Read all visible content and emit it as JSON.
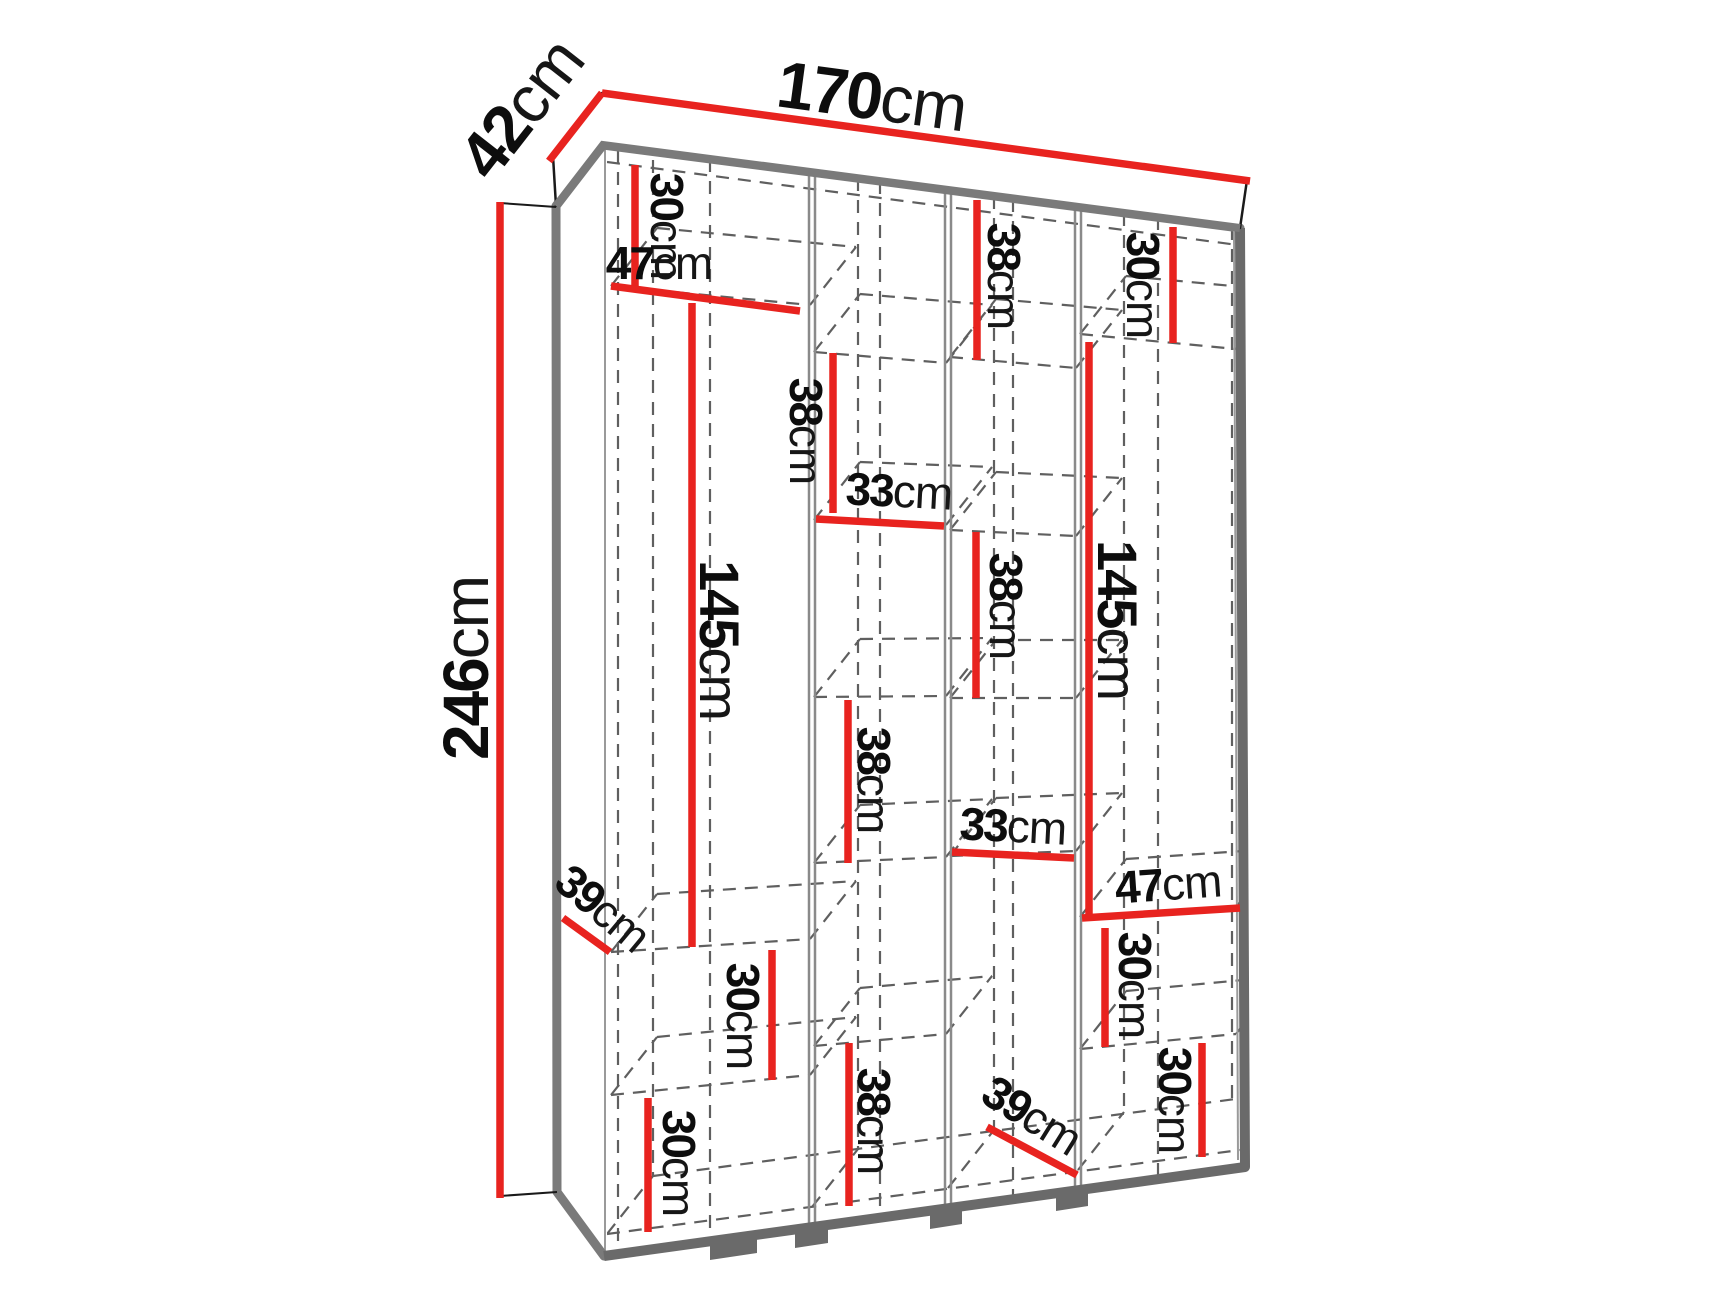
{
  "diagram": {
    "type": "furniture-dimension-diagram",
    "subject": "wardrobe-with-shelves",
    "unit": "cm",
    "overall": {
      "width": "170",
      "depth": "42",
      "height": "246"
    },
    "colors": {
      "dimension_line": "#e8231f",
      "structure_edge": "#7a7a7a",
      "structure_edge_dark": "#6a6a6a",
      "dashed_line": "#5f5f5f",
      "partition_line": "#8a8a8a",
      "label_text": "#0d0d0d",
      "background": "#ffffff"
    },
    "dimensions": [
      {
        "id": "width-top",
        "value": "170",
        "unit": "cm",
        "x1": 602,
        "y1": 93,
        "x2": 1250,
        "y2": 181,
        "lx": 872,
        "ly": 96,
        "rot": 7.7,
        "size": 66
      },
      {
        "id": "depth-top",
        "value": "42",
        "unit": "cm",
        "x1": 549,
        "y1": 161,
        "x2": 602,
        "y2": 93,
        "lx": 521,
        "ly": 108,
        "rot": -52,
        "size": 66
      },
      {
        "id": "height-left",
        "value": "246",
        "unit": "cm",
        "x1": 500,
        "y1": 202,
        "x2": 500,
        "y2": 1198,
        "lx": 466,
        "ly": 668,
        "rot": -90,
        "size": 64
      },
      {
        "id": "c1-top-30",
        "value": "30",
        "unit": "cm",
        "x1": 635,
        "y1": 165,
        "x2": 635,
        "y2": 287,
        "lx": 667,
        "ly": 226,
        "rot": 90,
        "size": 46
      },
      {
        "id": "c1-width-47",
        "value": "47",
        "unit": "cm",
        "x1": 611,
        "y1": 286,
        "x2": 800,
        "y2": 311,
        "lx": 659,
        "ly": 263,
        "rot": 0,
        "size": 46
      },
      {
        "id": "c1-hang-145",
        "value": "145",
        "unit": "cm",
        "x1": 692,
        "y1": 303,
        "x2": 692,
        "y2": 947,
        "lx": 720,
        "ly": 640,
        "rot": 90,
        "size": 56
      },
      {
        "id": "c1-depth-39",
        "value": "39",
        "unit": "cm",
        "x1": 563,
        "y1": 918,
        "x2": 610,
        "y2": 952,
        "lx": 603,
        "ly": 908,
        "rot": 40,
        "size": 46
      },
      {
        "id": "c1-shelf-30a",
        "value": "30",
        "unit": "cm",
        "x1": 772,
        "y1": 950,
        "x2": 772,
        "y2": 1080,
        "lx": 743,
        "ly": 1016,
        "rot": 90,
        "size": 46
      },
      {
        "id": "c1-shelf-30b",
        "value": "30",
        "unit": "cm",
        "x1": 648,
        "y1": 1098,
        "x2": 648,
        "y2": 1232,
        "lx": 679,
        "ly": 1163,
        "rot": 90,
        "size": 46
      },
      {
        "id": "c2-38a",
        "value": "38",
        "unit": "cm",
        "x1": 833,
        "y1": 353,
        "x2": 833,
        "y2": 513,
        "lx": 806,
        "ly": 431,
        "rot": 90,
        "size": 46
      },
      {
        "id": "c2-width-33",
        "value": "33",
        "unit": "cm",
        "x1": 816,
        "y1": 519,
        "x2": 944,
        "y2": 526,
        "lx": 899,
        "ly": 491,
        "rot": 3,
        "size": 46
      },
      {
        "id": "c2-38b",
        "value": "38",
        "unit": "cm",
        "x1": 848,
        "y1": 700,
        "x2": 848,
        "y2": 863,
        "lx": 874,
        "ly": 780,
        "rot": 90,
        "size": 46
      },
      {
        "id": "c2-38c",
        "value": "38",
        "unit": "cm",
        "x1": 849,
        "y1": 1043,
        "x2": 849,
        "y2": 1206,
        "lx": 874,
        "ly": 1121,
        "rot": 90,
        "size": 46
      },
      {
        "id": "c3-top-38",
        "value": "38",
        "unit": "cm",
        "x1": 977,
        "y1": 200,
        "x2": 977,
        "y2": 360,
        "lx": 1004,
        "ly": 276,
        "rot": 90,
        "size": 46
      },
      {
        "id": "c3-38b",
        "value": "38",
        "unit": "cm",
        "x1": 976,
        "y1": 532,
        "x2": 976,
        "y2": 698,
        "lx": 1006,
        "ly": 606,
        "rot": 90,
        "size": 46
      },
      {
        "id": "c3-width-33",
        "value": "33",
        "unit": "cm",
        "x1": 952,
        "y1": 852,
        "x2": 1074,
        "y2": 858,
        "lx": 1013,
        "ly": 826,
        "rot": 3,
        "size": 46
      },
      {
        "id": "c3-depth-39",
        "value": "39",
        "unit": "cm",
        "x1": 987,
        "y1": 1127,
        "x2": 1077,
        "y2": 1175,
        "lx": 1032,
        "ly": 1115,
        "rot": 32,
        "size": 46
      },
      {
        "id": "c4-top-30",
        "value": "30",
        "unit": "cm",
        "x1": 1173,
        "y1": 227,
        "x2": 1173,
        "y2": 343,
        "lx": 1143,
        "ly": 285,
        "rot": 90,
        "size": 46
      },
      {
        "id": "c4-hang-145",
        "value": "145",
        "unit": "cm",
        "x1": 1089,
        "y1": 342,
        "x2": 1089,
        "y2": 918,
        "lx": 1118,
        "ly": 620,
        "rot": 90,
        "size": 56
      },
      {
        "id": "c4-width-47",
        "value": "47",
        "unit": "cm",
        "x1": 1082,
        "y1": 918,
        "x2": 1240,
        "y2": 908,
        "lx": 1168,
        "ly": 884,
        "rot": -4,
        "size": 46
      },
      {
        "id": "c4-shelf-30a",
        "value": "30",
        "unit": "cm",
        "x1": 1105,
        "y1": 928,
        "x2": 1105,
        "y2": 1047,
        "lx": 1135,
        "ly": 985,
        "rot": 90,
        "size": 46
      },
      {
        "id": "c4-shelf-30b",
        "value": "30",
        "unit": "cm",
        "x1": 1202,
        "y1": 1043,
        "x2": 1202,
        "y2": 1157,
        "lx": 1175,
        "ly": 1100,
        "rot": 90,
        "size": 46
      }
    ]
  }
}
